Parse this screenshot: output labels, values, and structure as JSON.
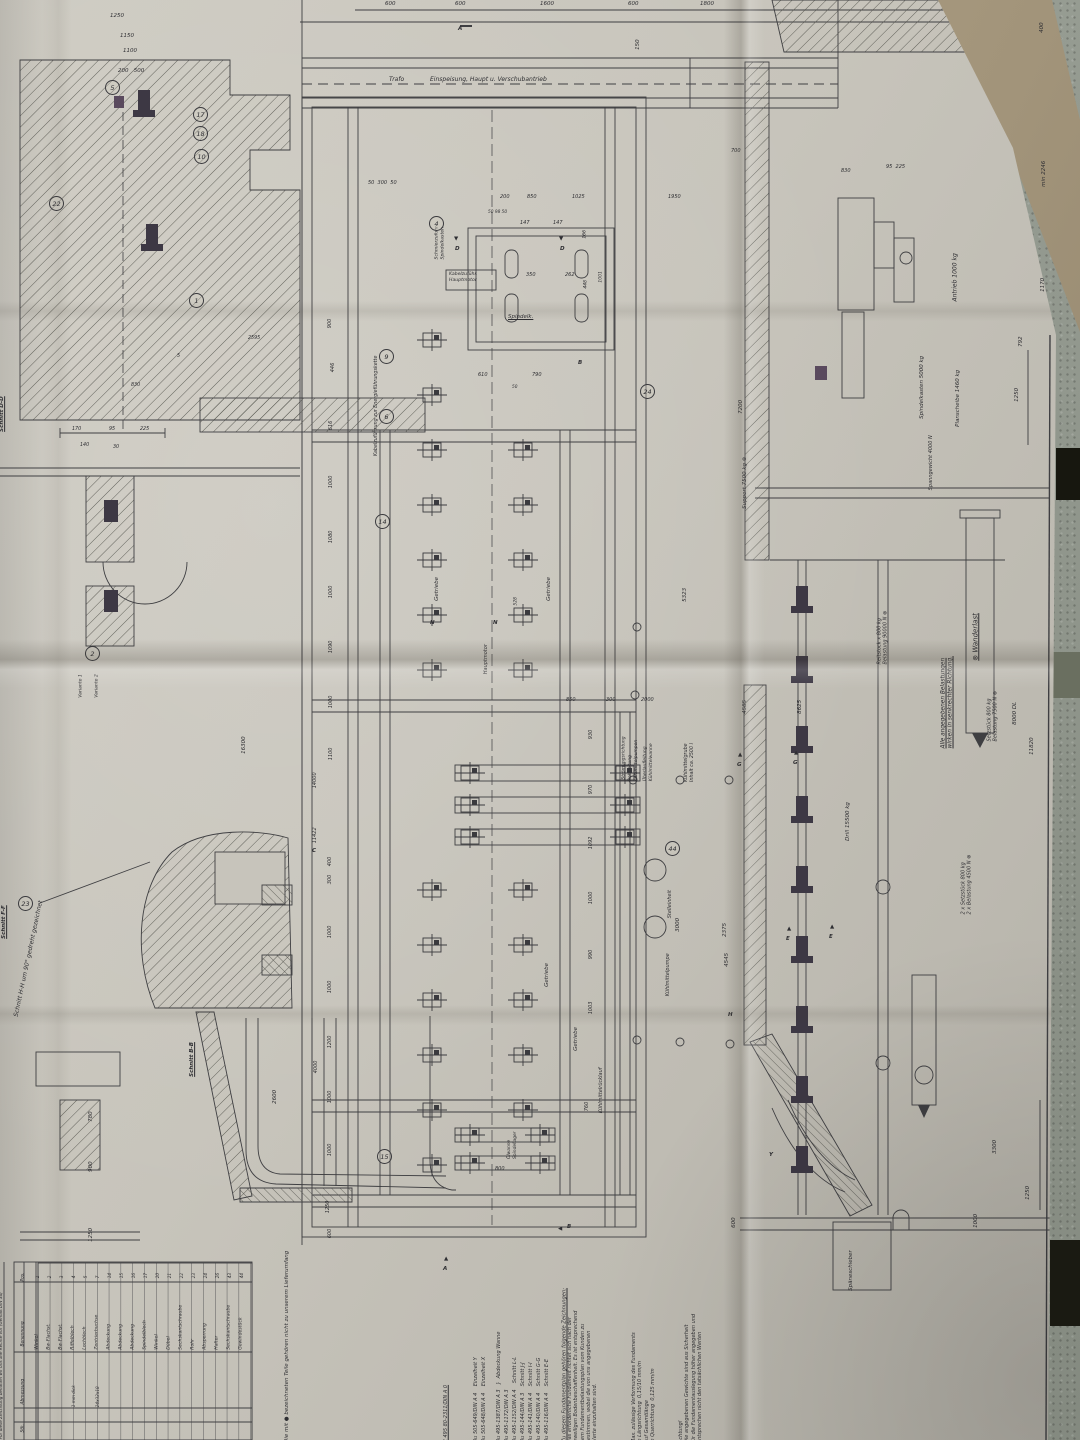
{
  "colors": {
    "paper": "#c7c4bb",
    "table": "#9aa096",
    "ink": "#3f3f42",
    "anchor_dark": "#3d3844",
    "magenta_block": "#5a4a5e",
    "tan_flap": "#a2947a"
  },
  "header": {
    "trafo": "Trafo",
    "feed": "Einspeisung, Haupt u. Verschubantrieb"
  },
  "sections": {
    "dd": "Schnitt D-D",
    "ff": "Schnitt F-F",
    "hh": "Schnitt H-H um 90° gedreht gezeichnet",
    "bb": "Schnitt B-B"
  },
  "markers": {
    "a": "A",
    "a2": "A",
    "b": "B",
    "b2": "B",
    "c": "C",
    "d": "D",
    "d2": "D",
    "e": "E",
    "e2": "E",
    "g": "G",
    "g2": "G",
    "h": "H",
    "n": "N",
    "n2": "N",
    "y": "Y"
  },
  "loads": {
    "wanderlast": "⊗ Wanderlast",
    "note": "Alle angegebenen Belastungen\nwirken in senkrechter Richtung.",
    "antrieb": "Antrieb 1000 kg",
    "planscheibe": "Planscheibe 1460 kg",
    "spindelkasten": "Spindelkasten 5000 kg",
    "spanngewicht": "Spanngewicht 4000 N",
    "support": "Support 7500 kg ⊗",
    "reitstock": "Reitstock x 800 kg\nBelastung 90000 N ⊗",
    "setzstueck": "Setzstück 800 kg\nBelastung 7500 N ⊗",
    "setzstueck2": "2 x Setzstück 800 kg\n2 x Belastung 4500 N ⊗",
    "drill": "Drill 15500 kg",
    "dauerlast": "8000 DL"
  },
  "plan": {
    "spindel": "Spindelk.",
    "kabel_haupt": "Kabelzuführ.\nHauptmotor",
    "kabel_kette": "Kabelzuführung zur Energieführungskette",
    "schmier": "Schmierzufuhr\nSpindelkasten",
    "getriebe": "Getriebe",
    "hauptmotor": "Hauptmotor",
    "grube": "Kühlmittelgrube\nInhalt ca. 2500 l",
    "ueberlauf": "Überlaufleitung\nKühlmittelwanne",
    "rohr": "Rohrleitung\nKühlmittelpumpen",
    "stroemung": "Strömungsrichtung",
    "stelleinheit": "Stelleinheit",
    "pumpe": "Kühlmittelpumpe",
    "ruecklauf": "Kühlmittelrücklauf",
    "oelwanne": "Ölwanne\nSpindellager",
    "spaene": "Späneschieber"
  },
  "balloons": [
    "5",
    "17",
    "18",
    "10",
    "22",
    "1",
    "2",
    "23",
    "4",
    "9",
    "6",
    "24",
    "14",
    "44",
    "15"
  ],
  "dims": {
    "top_row": [
      "600",
      "600",
      "1600",
      "600",
      "1800"
    ],
    "tl": [
      "1250",
      "1150",
      "1100",
      "200   500"
    ],
    "left_edge": [
      "160",
      "258",
      "100",
      "190",
      "258",
      "300",
      "856",
      "533",
      "573",
      "700",
      "350",
      "140",
      "400",
      "303"
    ],
    "dd": [
      "170",
      "95",
      "225",
      "140",
      "30",
      "830",
      "5",
      "2595",
      "143",
      "156",
      "143"
    ],
    "plan_top": [
      "50  300  50",
      "200",
      "850",
      "1025",
      "1950",
      "50 98 50",
      "147",
      "147",
      "350",
      "262",
      "610",
      "790",
      "50"
    ],
    "left_chain": [
      "900",
      "446",
      "616",
      "1000",
      "1080",
      "1000",
      "1090",
      "1000",
      "1100",
      "14000",
      "11422",
      "400",
      "300",
      "1000",
      "1000",
      "1200",
      "4000",
      "1000",
      "1000",
      "1250",
      "600"
    ],
    "right_chain": [
      "528",
      "1001",
      "448",
      "166",
      "930",
      "970",
      "1092",
      "1000",
      "990",
      "1003",
      "760"
    ],
    "misc": [
      "850",
      "300",
      "2000",
      "5323",
      "4585",
      "2375",
      "3000",
      "16300",
      "2600",
      "800",
      "1250",
      "8625",
      "4545",
      "150",
      "700",
      "830",
      "95  225",
      "1170",
      "min 2246",
      "792",
      "1250",
      "7200",
      "3300",
      "1000",
      "600",
      "11820",
      "400",
      "780",
      "900",
      "1250"
    ]
  },
  "notes": {
    "achtung": "Achtung!\nDie angegebenen Gewichte sind aus Sicherheit\nfür die Fundamentauslegung höher angegeben und\nentsprechen nicht den tatsächlichen Werten",
    "verformung": "Max. zulässige Verformung des Fundaments\nin Längsrichtung  0,15/10 mm/m\nauf Gesamtlänge\nin Querrichtung  0,125 mm/m",
    "fundament": "Das erforderliche Fundament richtet sich nach der\njeweiligen Bodenbeschaffenheit. Es ist entsprechend\ndem Fundamentbelastungsplan vom Kunden zu\nbestimmen, wobei die von uns angegebenen\nWerte einzuhalten sind.",
    "list_intro": "Zu diesem Fundamentplan gehören folgende Zeichnungen:",
    "parts_note": "Die mit ● bezeichneten Teile gehören nicht zu unserem Lieferumfang",
    "rights": "Für diese Zeichnung behalten wir uns alle Rechte vor (Gemäß DIN 34)"
  },
  "drawing_list": [
    "Bu 495-116/DIN A 4    Schnitt E-E",
    "Bu 495-140/DIN A 4    Schnitt G-G",
    "Bu 495-141/DIN A 4    Schnitt I-I",
    "Bu 495-144/DIN A 3    Schnitt J-J",
    "Bu 495-1152/DIN A 4    Schnitt L-L",
    "Bu 495-1172/DIN A 3",
    "Bu 495-1387/DIN A 3   }  Abdeckung Wanne",
    "Bu 505-648/DIN A 4    Einzelheit X",
    "Bu 505-649/DIN A 4    Einzelheit Y",
    "E 495 80-2311/DIN A 0"
  ],
  "parts_table": {
    "headers": [
      "Pos.",
      "Benennung",
      "Abmessung",
      "Stk."
    ],
    "rows": [
      {
        "pos": "1",
        "name": "Winkel"
      },
      {
        "pos": "2",
        "name": "Bw-Flachst."
      },
      {
        "pos": "3",
        "name": "Bw-Flachst."
      },
      {
        "pos": "4",
        "name": "Riffelblech",
        "dim": "1 mm dick"
      },
      {
        "pos": "5",
        "name": "Lochblech"
      },
      {
        "pos": "7",
        "name": "Zentrierbuchse",
        "dim": "24x32x18"
      },
      {
        "pos": "14",
        "name": "Abdeckung"
      },
      {
        "pos": "15",
        "name": "Abdeckung"
      },
      {
        "pos": "16",
        "name": "Abdeckung"
      },
      {
        "pos": "17",
        "name": "Spindelblech"
      },
      {
        "pos": "20",
        "name": "Winkel"
      },
      {
        "pos": "21",
        "name": "Dübel"
      },
      {
        "pos": "22",
        "name": "Sechskantschraube"
      },
      {
        "pos": "23",
        "name": "Rohr"
      },
      {
        "pos": "24",
        "name": "Absperrung"
      },
      {
        "pos": "26",
        "name": "Halter"
      },
      {
        "pos": "43",
        "name": "Sechskantschraube"
      },
      {
        "pos": "44",
        "name": "Gewindestück"
      }
    ]
  }
}
